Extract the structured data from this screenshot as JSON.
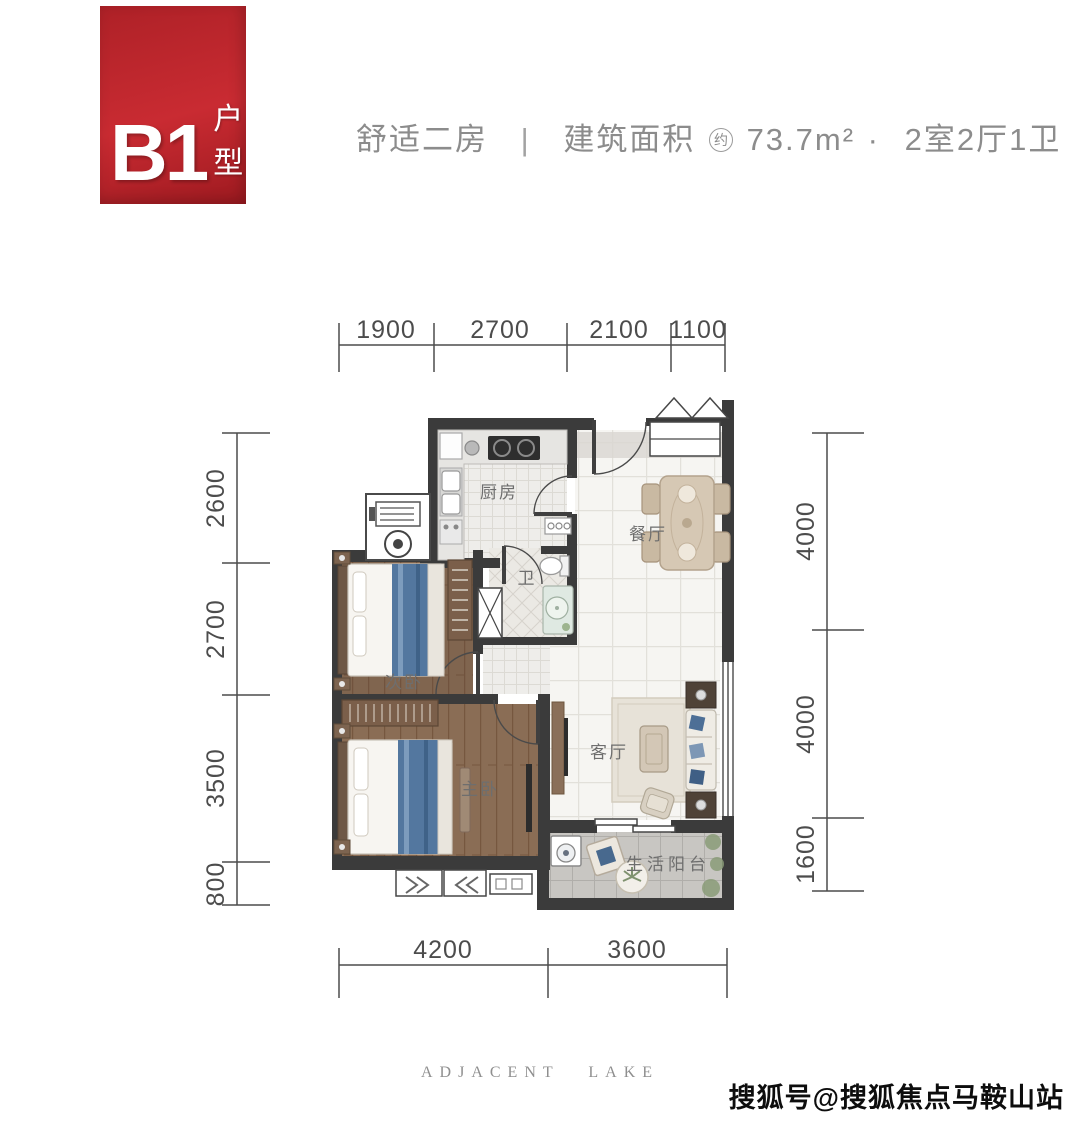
{
  "header": {
    "badge": {
      "code": "B1",
      "label": "户型",
      "color": "#b91f26"
    },
    "title": {
      "layout_type": "舒适二房",
      "divider": "|",
      "area_label": "建筑面积",
      "area_approx": "约",
      "area_value": "73.7m²",
      "dot": "·",
      "rooms_summary": "2室2厅1卫"
    }
  },
  "floor_plan": {
    "rooms": {
      "kitchen": "厨房",
      "bathroom": "卫",
      "dining": "餐厅",
      "bedroom2": "次卧",
      "master": "主卧",
      "living": "客厅",
      "balcony": "生活阳台"
    },
    "dimensions": {
      "top": [
        "1900",
        "2700",
        "2100",
        "1100"
      ],
      "left": [
        "2600",
        "2700",
        "3500",
        "800"
      ],
      "right": [
        "4000",
        "4000",
        "1600"
      ],
      "bottom": [
        "4200",
        "3600"
      ]
    },
    "colors": {
      "wall": "#3b3b3b",
      "wood_floor": "#8a6d55",
      "accent_blue": "#53779f"
    }
  },
  "footer": {
    "brand": "ADJACENT LAKE"
  },
  "watermark": {
    "text": "搜狐号@搜狐焦点马鞍山站"
  }
}
